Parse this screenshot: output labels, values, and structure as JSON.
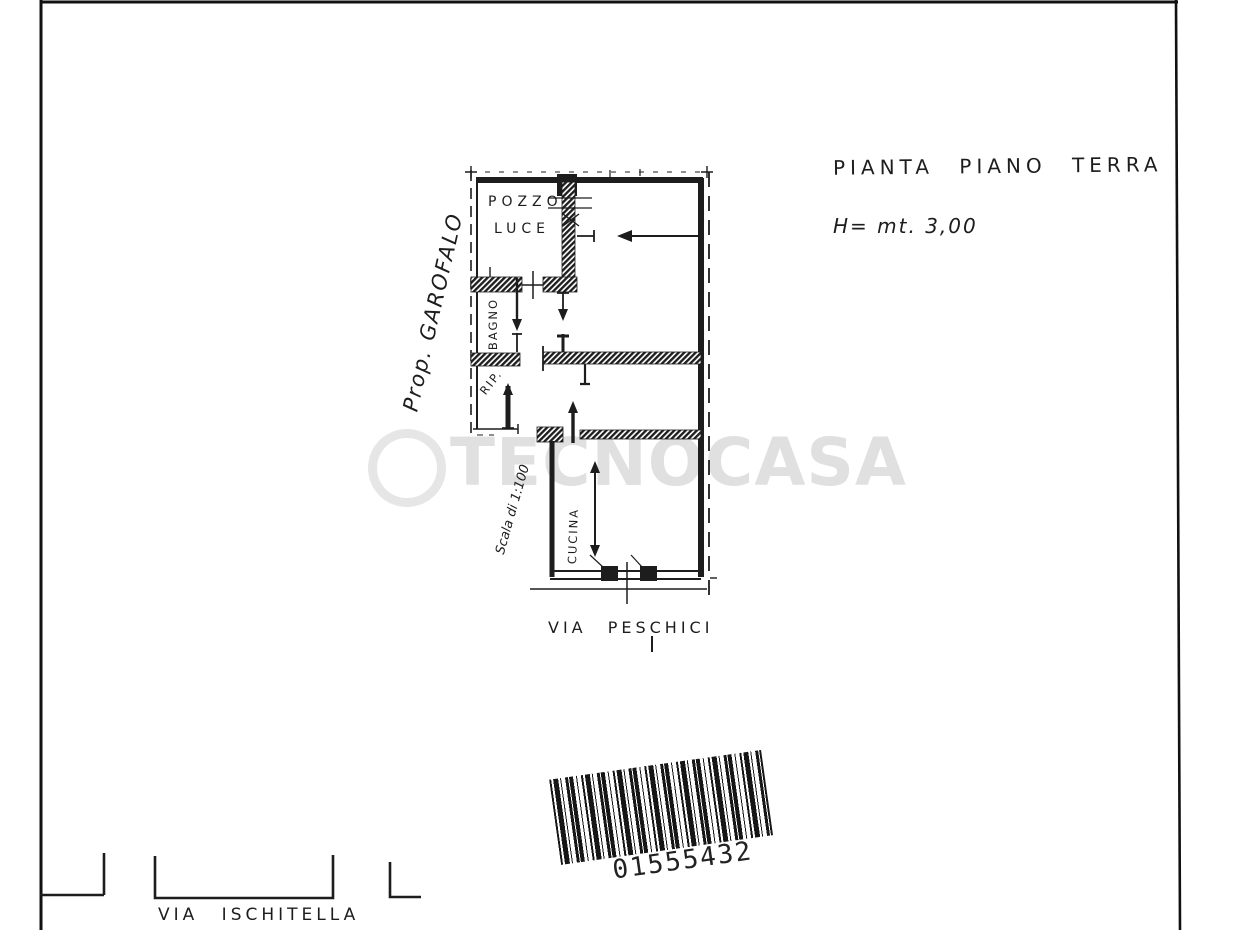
{
  "annotations": {
    "title": "PIANTA PIANO TERRA",
    "height_note": "H= mt. 3,00",
    "owner_note": "Prop. GAROFALO",
    "scale_note": "Scala di 1:100"
  },
  "plan": {
    "room_labels": {
      "pozzo_luce_line1": "POZZO",
      "pozzo_luce_line2": "LUCE",
      "bagno": "BAGNO",
      "rip": "RIP.",
      "cucina": "CUCINA"
    },
    "streets": {
      "plan_street": "VIA PESCHICI",
      "page_street": "VIA ISCHITELLA"
    }
  },
  "barcode": {
    "value": "01555432"
  },
  "watermark": {
    "text": "TECNOCASA"
  },
  "colors": {
    "ink": "#1d1d1d",
    "paper": "#ffffff",
    "watermark": "#e0e0e0"
  }
}
